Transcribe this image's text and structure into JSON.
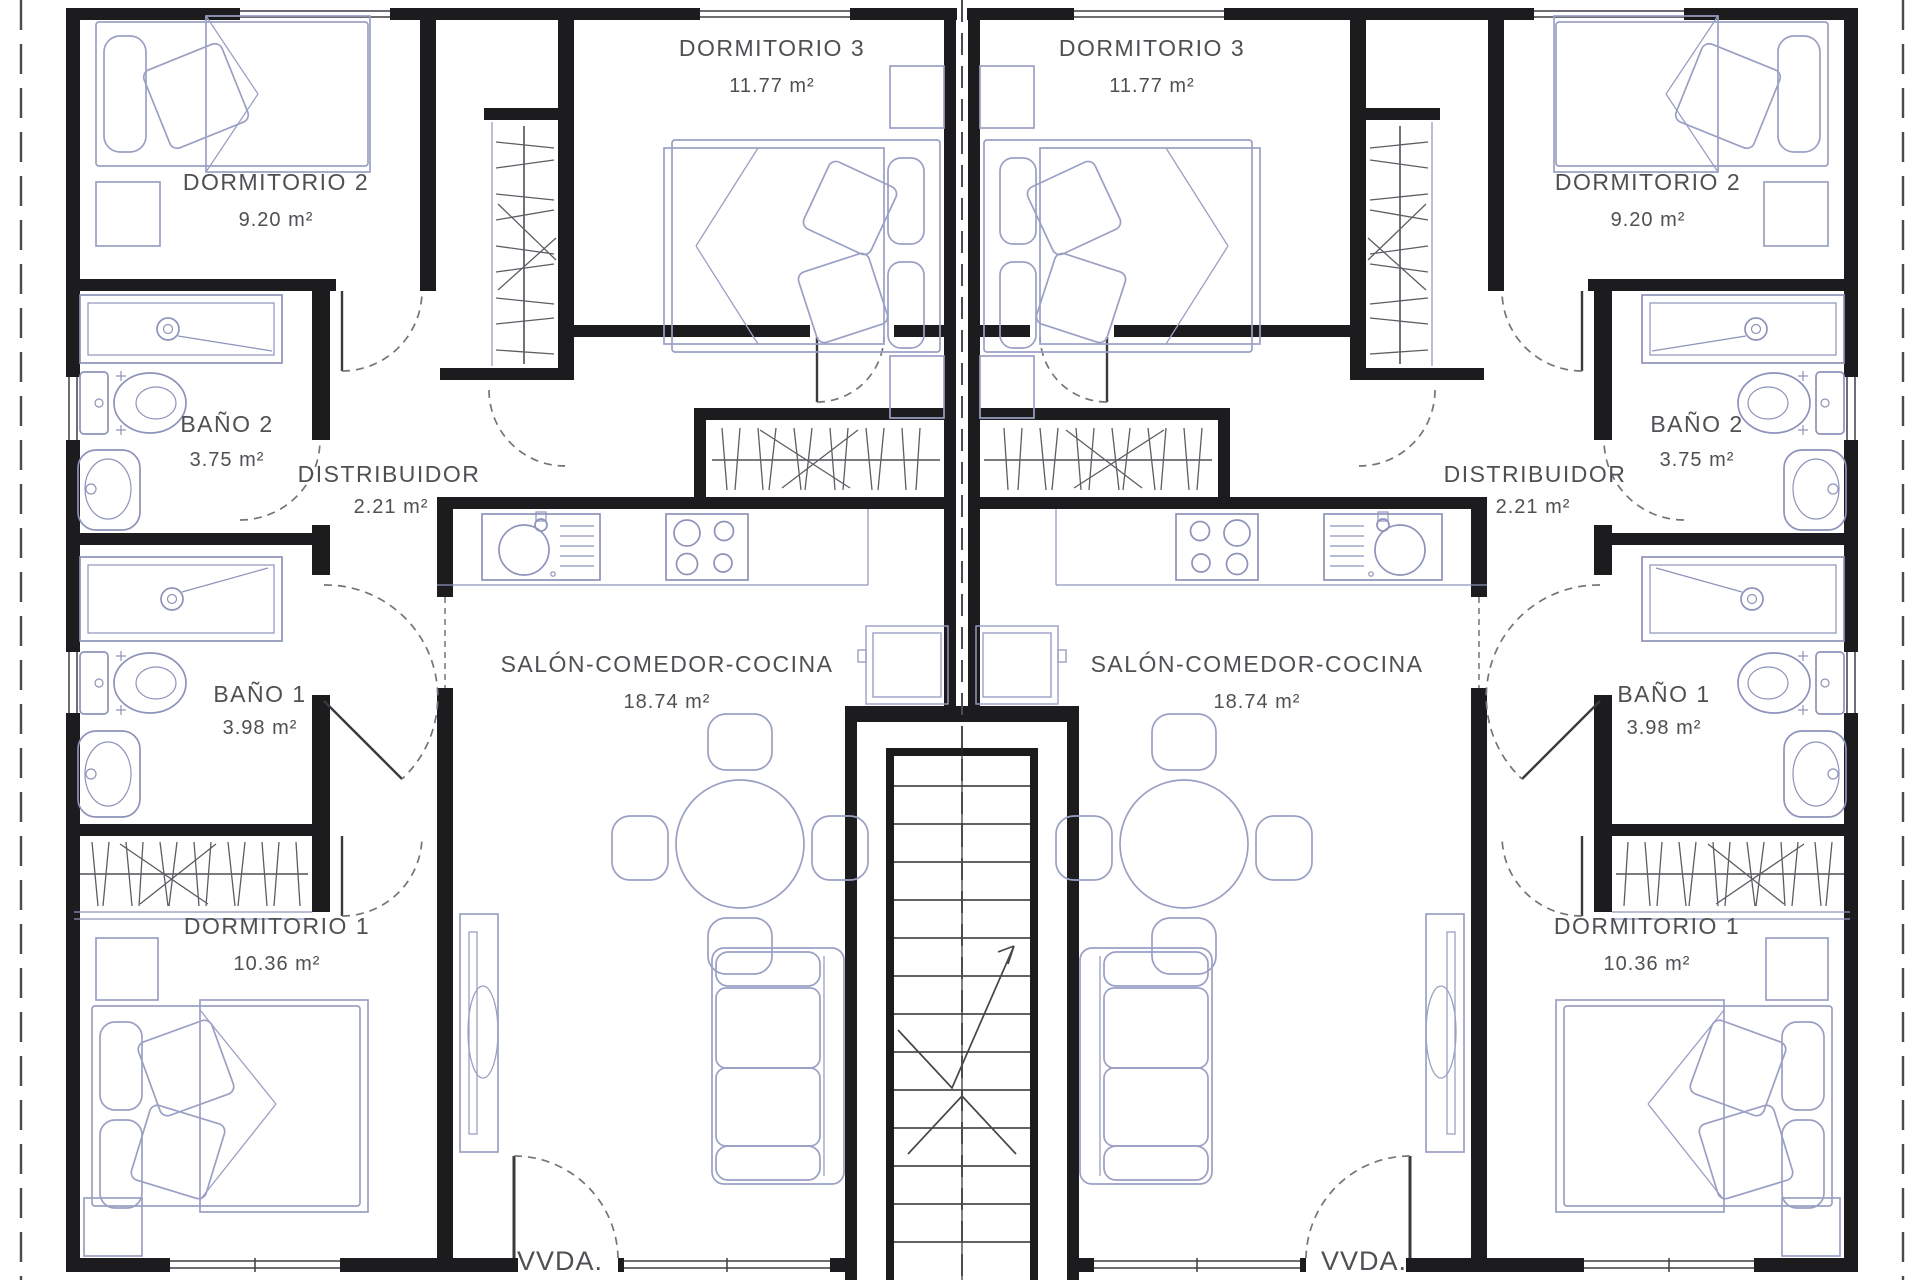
{
  "plan_title": "Planta de dos viviendas simétricas",
  "colors": {
    "wall": "#1c1c1e",
    "furniture": "#9aa0c4",
    "fixture": "#8d93ba",
    "label_text": "#4f4f54",
    "door_arc": "#74747a",
    "background": "#ffffff"
  },
  "rooms": {
    "dormitorio1": {
      "name": "DORMITORIO 1",
      "area": "10.36 m²"
    },
    "dormitorio2": {
      "name": "DORMITORIO 2",
      "area": "9.20 m²"
    },
    "dormitorio3": {
      "name": "DORMITORIO 3",
      "area": "11.77 m²"
    },
    "bano1": {
      "name": "BAÑO 1",
      "area": "3.98 m²"
    },
    "bano2": {
      "name": "BAÑO 2",
      "area": "3.75 m²"
    },
    "distribuidor": {
      "name": "DISTRIBUIDOR",
      "area": "2.21 m²"
    },
    "salon": {
      "name": "SALÓN-COMEDOR-COCINA",
      "area": "18.74 m²"
    }
  },
  "units": {
    "left": {
      "label": "VVDA.",
      "number": "1"
    },
    "right": {
      "label": "VVDA.",
      "number": "2"
    }
  }
}
